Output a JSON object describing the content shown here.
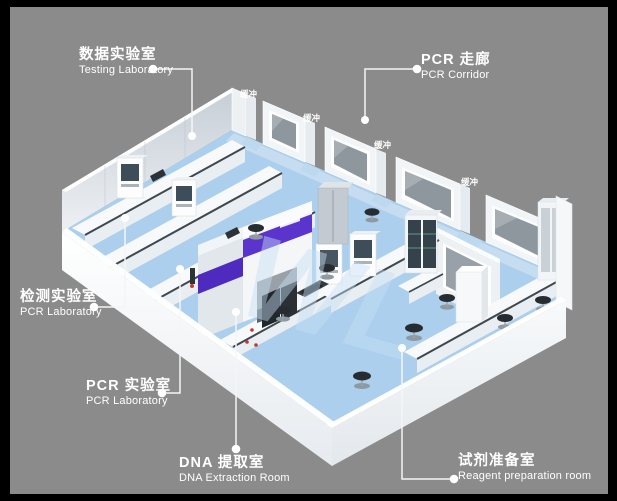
{
  "frame": {
    "border_color": "#000000",
    "background_color": "#8b8b8b"
  },
  "watermark": {
    "text": "WL",
    "color": "#c7e0f5"
  },
  "buffers": [
    {
      "label": "缓冲"
    },
    {
      "label": "缓冲"
    },
    {
      "label": "缓冲"
    },
    {
      "label": "缓冲"
    }
  ],
  "callouts": [
    {
      "id": "testing-laboratory",
      "title_zh": "数据实验室",
      "title_en": "Testing Laboratory"
    },
    {
      "id": "pcr-corridor",
      "title_zh": "PCR 走廊",
      "title_en": "PCR Corridor"
    },
    {
      "id": "detection-laboratory",
      "title_zh": "检测实验室",
      "title_en": "PCR Laboratory"
    },
    {
      "id": "pcr-laboratory",
      "title_zh": "PCR 实验室",
      "title_en": "PCR Laboratory"
    },
    {
      "id": "dna-extraction-room",
      "title_zh": "DNA 提取室",
      "title_en": "DNA Extraction Room"
    },
    {
      "id": "reagent-preparation",
      "title_zh": "试剂准备室",
      "title_en": "Reagent preparation room"
    }
  ],
  "scene_colors": {
    "floor_blue": "#abcfec",
    "corridor_blue": "#c9def2",
    "wall_white": "#f2f5f7",
    "window_glass": "#8e969e",
    "accent_purple": "#5a34cd",
    "accent_purple_dark": "#4e2abf",
    "bench_edge": "#3f474f",
    "stool_dark": "#272c31"
  }
}
